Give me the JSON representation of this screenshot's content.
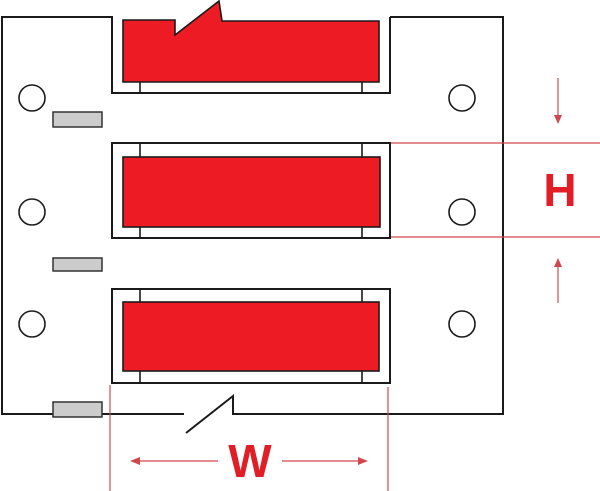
{
  "diagram": {
    "description": "Wire marker sleeve label strip with width and height dimension callouts",
    "sleeve_count": 3,
    "feed_hole_count": 6,
    "notch_count": 3,
    "dimension_labels": {
      "width": "W",
      "height": "H"
    }
  },
  "colors": {
    "label_red": "#ed1c24",
    "dimension_red": "#d0484e",
    "outline_black": "#1a1a1a",
    "notch_gray": "#cccccc",
    "carrier_white": "#ffffff"
  }
}
